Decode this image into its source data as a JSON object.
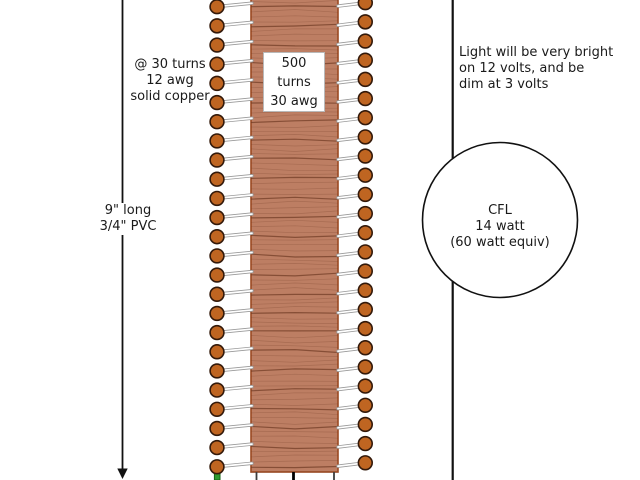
{
  "diagram": {
    "background_color": "#ffffff",
    "primary_label": {
      "lines": [
        "@ 30 turns",
        "12 awg",
        "solid copper"
      ]
    },
    "secondary_label": {
      "lines": [
        "500",
        "turns",
        "30 awg"
      ]
    },
    "pvc_label": {
      "lines": [
        "9\" long",
        "3/4\" PVC"
      ]
    },
    "light_note": {
      "lines": [
        "Light will be very bright",
        "on 12 volts, and be",
        "dim at 3 volts"
      ]
    },
    "cfl_label": {
      "lines": [
        "CFL",
        "14 watt",
        "(60 watt equiv)"
      ]
    }
  },
  "coil": {
    "turns_per_side": 25,
    "body_color": "#bd7e63",
    "body_edge_color": "#9c4a22",
    "texture_color": "#6f3a24",
    "wire_dot_color": "#bf6521",
    "wire_dot_outline": "#33190a",
    "wire_color": "#ffffff",
    "wire_outline": "#9a9a9a",
    "terminal_color": "#2e9b2f",
    "terminal_edge_color": "#156315",
    "leg_color": "#3d3d3d",
    "line_color": "#111111",
    "text_color": "#1a1a1a"
  }
}
